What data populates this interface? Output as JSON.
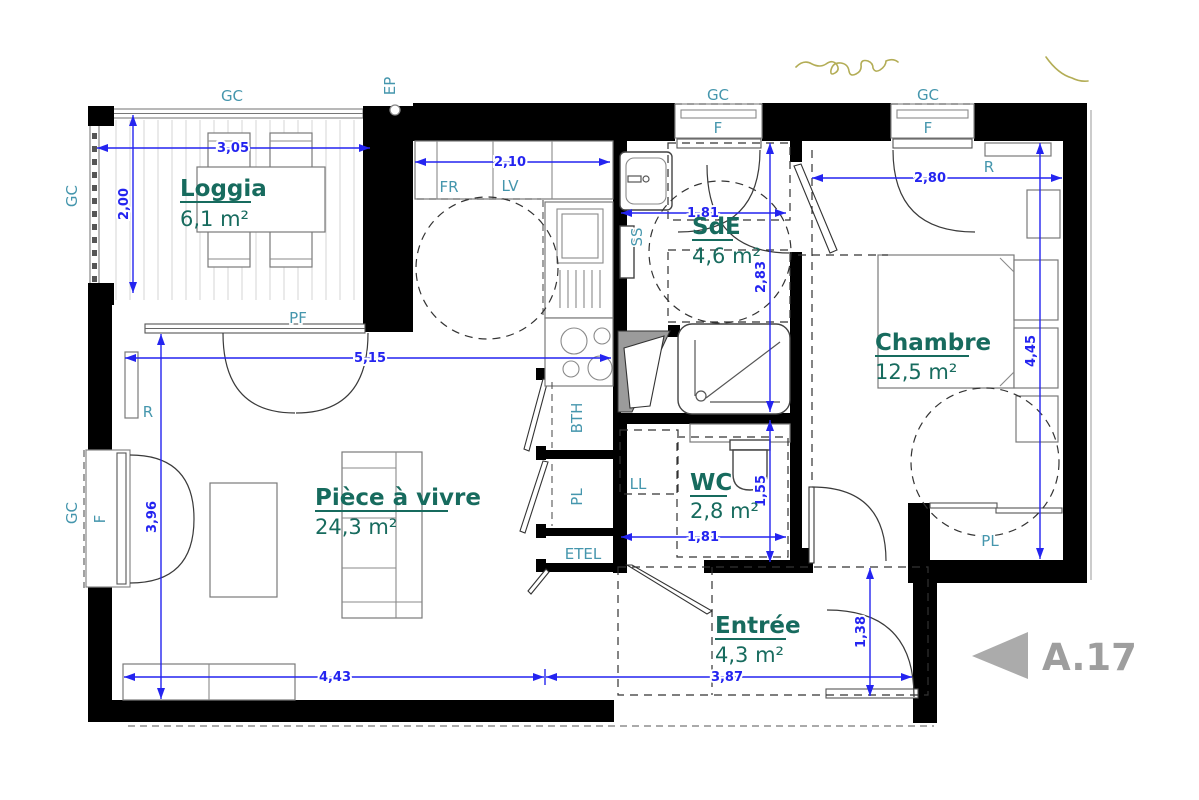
{
  "rooms": {
    "loggia": {
      "name": "Loggia",
      "area": "6,1 m²"
    },
    "living": {
      "name": "Pièce à vivre",
      "area": "24,3 m²"
    },
    "sde": {
      "name": "SdE",
      "area": "4,6 m²"
    },
    "chambre": {
      "name": "Chambre",
      "area": "12,5 m²"
    },
    "wc": {
      "name": "WC",
      "area": "2,8 m²"
    },
    "entree": {
      "name": "Entrée",
      "area": "4,3 m²"
    }
  },
  "dims": {
    "loggia_w": "3,05",
    "loggia_h": "2,00",
    "kitchen_w": "2,10",
    "sde_w": "1,81",
    "sde_h": "2,83",
    "chambre_w": "2,80",
    "chambre_h": "4,45",
    "living_w": "5,15",
    "living_h": "3,96",
    "wc_w": "1,81",
    "wc_h": "1,55",
    "living_bottom": "4,43",
    "entree_w": "3,87",
    "entree_h": "1,38"
  },
  "tags": {
    "gc": "GC",
    "ep": "EP",
    "pf": "PF",
    "fr": "FR",
    "lv": "LV",
    "ss": "SS",
    "f": "F",
    "r": "R",
    "ll": "LL",
    "bth": "BTH",
    "pl": "PL",
    "etel": "ETEL"
  },
  "reference": {
    "label": "A.17"
  },
  "colors": {
    "wall": "#000000",
    "dimension_blue": "#2424f0",
    "room_label_green": "#176b5e",
    "tag_teal": "#4596ad",
    "reference_gray": "#9e9e9e",
    "annotation_olive": "#b3ad56"
  }
}
